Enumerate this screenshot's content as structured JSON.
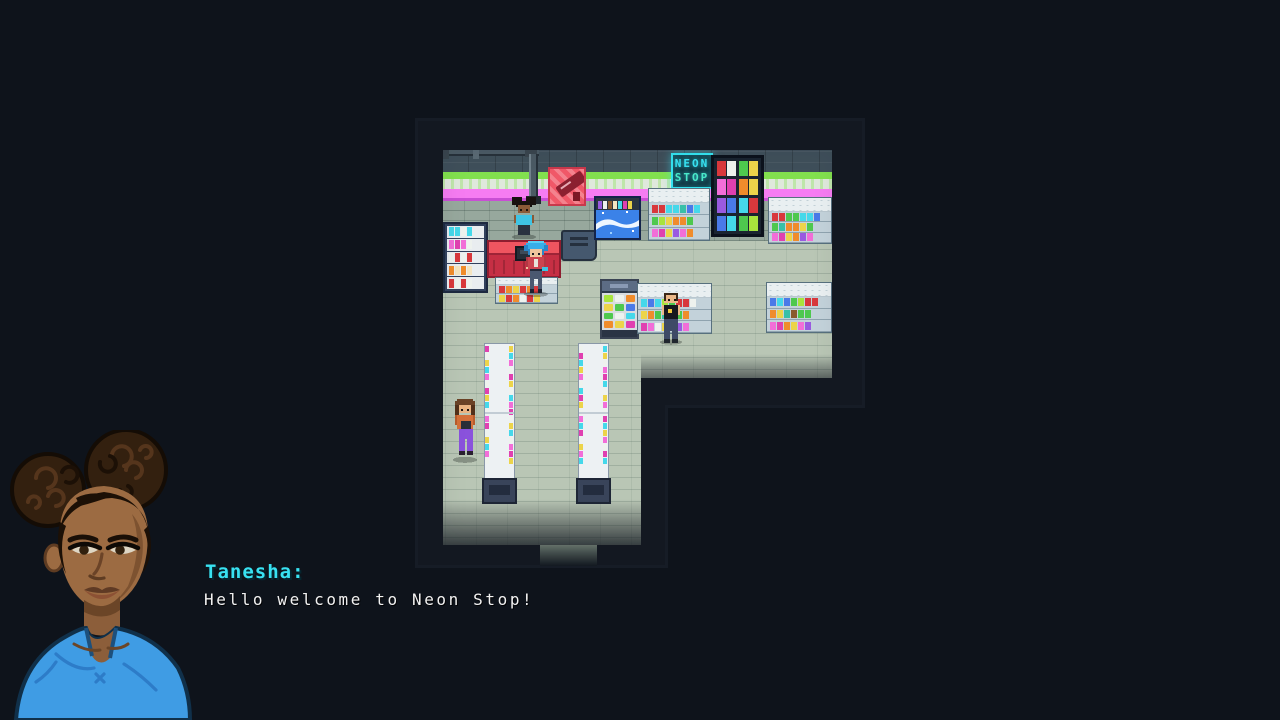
{
  "store": {
    "sign": {
      "line1": "NEON",
      "line2": "STOP"
    }
  },
  "dialogue": {
    "speaker": "Tanesha:",
    "text": "Hello welcome to Neon Stop!"
  },
  "colors": {
    "bg": "#0e131b",
    "floor": "#b9c6b5",
    "wall": "#3f4f5a",
    "stripe_green": "#82e04e",
    "stripe_pink": "#f67cf2",
    "accent": "#38e2f2",
    "counter": "#d8333f",
    "name": "#38e2f2",
    "text": "#f2f2f2"
  }
}
